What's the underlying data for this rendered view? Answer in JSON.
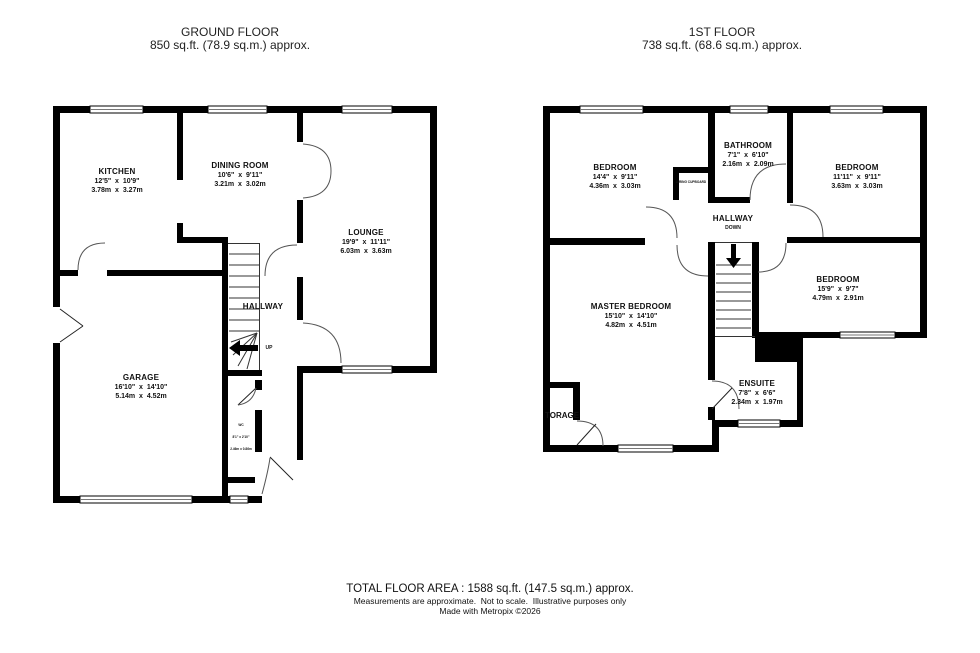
{
  "ground": {
    "title": "GROUND FLOOR",
    "area": "850 sq.ft. (78.9 sq.m.) approx.",
    "kitchen": {
      "name": "KITCHEN",
      "imperial": "12'5\"  x  10'9\"",
      "metric": "3.78m  x  3.27m"
    },
    "dining": {
      "name": "DINING ROOM",
      "imperial": "10'6\"  x  9'11\"",
      "metric": "3.21m  x  3.02m"
    },
    "lounge": {
      "name": "LOUNGE",
      "imperial": "19'9\"  x  11'11\"",
      "metric": "6.03m  x  3.63m"
    },
    "garage": {
      "name": "GARAGE",
      "imperial": "16'10\"  x  14'10\"",
      "metric": "5.14m  x  4.52m"
    },
    "hallway": "HALLWAY",
    "up": "UP",
    "wc": {
      "name": "WC",
      "imperial": "8'1\" x 2'10\"",
      "metric": "2.46m x 0.86m"
    }
  },
  "first": {
    "title": "1ST FLOOR",
    "area": "738 sq.ft. (68.6 sq.m.) approx.",
    "bedroom1": {
      "name": "BEDROOM",
      "imperial": "14'4\"  x  9'11\"",
      "metric": "4.36m  x  3.03m"
    },
    "bathroom": {
      "name": "BATHROOM",
      "imperial": "7'1\"  x  6'10\"",
      "metric": "2.16m  x  2.09m"
    },
    "bedroom2": {
      "name": "BEDROOM",
      "imperial": "11'11\"  x  9'11\"",
      "metric": "3.63m  x  3.03m"
    },
    "bedroom3": {
      "name": "BEDROOM",
      "imperial": "15'9\"  x  9'7\"",
      "metric": "4.79m  x  2.91m"
    },
    "master": {
      "name": "MASTER BEDROOM",
      "imperial": "15'10\"  x  14'10\"",
      "metric": "4.82m  x  4.51m"
    },
    "ensuite": {
      "name": "ENSUITE",
      "imperial": "7'8\"  x  6'6\"",
      "metric": "2.34m  x  1.97m"
    },
    "hallway": "HALLWAY",
    "down": "DOWN",
    "airing": "AIRING CUPBOARD",
    "storage": "TORAGE"
  },
  "footer": {
    "total": "TOTAL FLOOR AREA : 1588 sq.ft. (147.5 sq.m.) approx.",
    "disclaimer": "Measurements are approximate.  Not to scale.  Illustrative purposes only",
    "credit": "Made with Metropix ©2026"
  }
}
